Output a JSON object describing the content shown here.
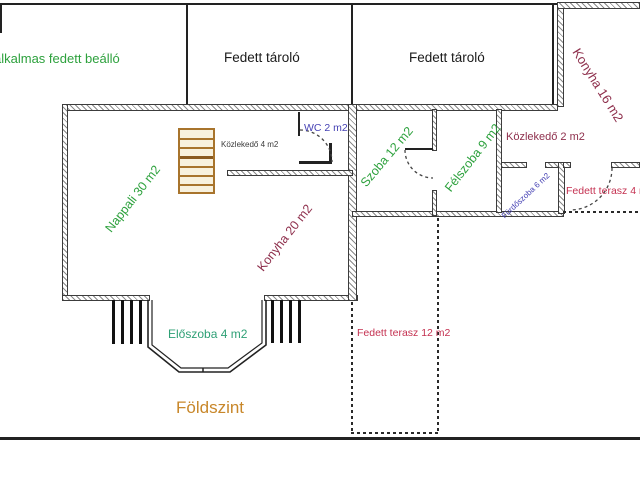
{
  "plan_title": "Földszint",
  "labels": {
    "carport": "alkalmas fedett beálló",
    "storage1": "Fedett tároló",
    "storage2": "Fedett tároló",
    "konyha16": "Konyha 16 m2",
    "nappali": "Nappali 30 m2",
    "kozlekedo4": "Közlekedő 4 m2",
    "wc": "WC 2 m2",
    "konyha20": "Konyha 20 m2",
    "szoba12": "Szoba 12 m2",
    "felszoba9": "Félszoba 9 m2",
    "kozlekedo2": "Közlekedő 2 m2",
    "furdoszoba6": "Fürdőszoba 6 m2",
    "terasz4": "Fedett terasz 4 m2",
    "eloszoba4": "Előszoba 4 m2",
    "terasz12": "Fedett terasz 12 m2",
    "floor": "Földszint"
  },
  "colors": {
    "green": "#2da13d",
    "teal": "#2fa076",
    "maroon": "#8e2f4c",
    "red": "#c43050",
    "blue": "#4642b4",
    "orange": "#c8872a",
    "ink": "#1a1a1a",
    "gray": "#3a3a3a"
  }
}
